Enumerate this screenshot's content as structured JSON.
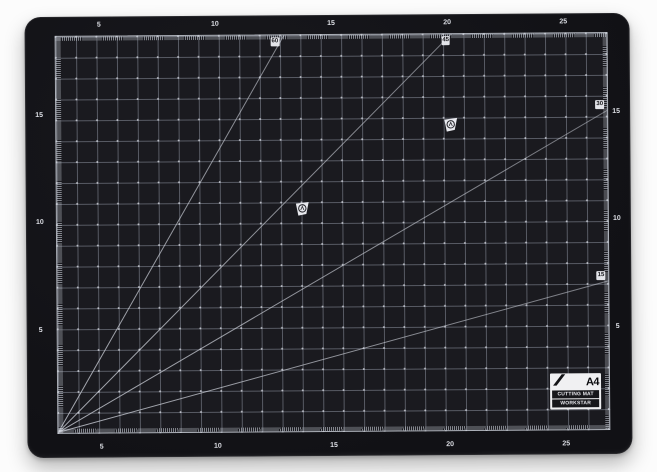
{
  "scene": {
    "background_color": "#fcfcfc",
    "subject": "Black A4 self-healing cutting mat, product photo"
  },
  "mat": {
    "colors": {
      "body": "#131317",
      "grid_background": "#1a1a1f",
      "grid_line": "#9aa0ae",
      "frame_line": "#c6cad2",
      "scale_digits": "#dcdee4",
      "diagonal_line": "#cfd3dc",
      "label_background": "#f0f0f2"
    },
    "scales": {
      "top": [
        "5",
        "10",
        "15",
        "20",
        "25"
      ],
      "bottom": [
        "5",
        "10",
        "15",
        "20",
        "25"
      ],
      "left": [
        "15",
        "10",
        "5"
      ],
      "right": [
        "15",
        "10",
        "5"
      ]
    },
    "angle_labels": [
      {
        "value": "60"
      },
      {
        "value": "45"
      },
      {
        "value": "30"
      },
      {
        "value": "15"
      }
    ],
    "corner_label": {
      "size": "A4",
      "line1": "CUTTING MAT",
      "line2": "WORKSTAR"
    },
    "icons": {
      "brand_watermark": "circled-monogram-flag",
      "blade": "craft-knife-blade"
    }
  }
}
